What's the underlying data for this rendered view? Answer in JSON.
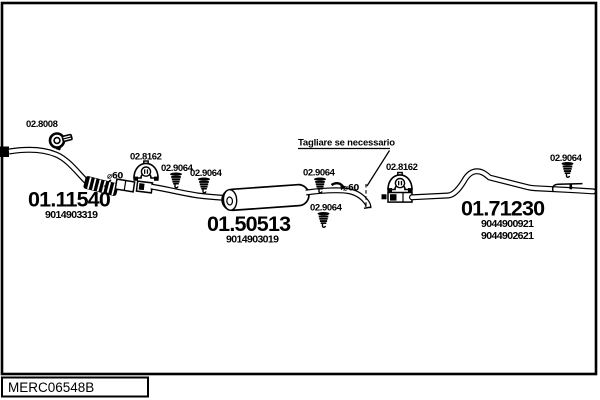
{
  "diagram": {
    "code_plate": "MERC06548B",
    "cut_note": "Tagliare se necessario",
    "front_pipe": {
      "code": "01.11540",
      "ref": "9014903319"
    },
    "silencer": {
      "code": "01.50513",
      "ref": "9014903019"
    },
    "tail_pipe": {
      "code": "01.71230",
      "refs": [
        "9044900921",
        "9044902621"
      ]
    },
    "clamp": {
      "code": "02.8008"
    },
    "brackets": [
      {
        "code": "02.8162"
      },
      {
        "code": "02.8162"
      }
    ],
    "hangers": [
      {
        "code": "02.9064"
      },
      {
        "code": "02.9064"
      },
      {
        "code": "02.9064"
      },
      {
        "code": "02.9064"
      },
      {
        "code": "02.9064"
      }
    ],
    "diameters": [
      "⌀60",
      "⌀60"
    ],
    "colors": {
      "ink": "#000000",
      "paper": "#ffffff"
    }
  }
}
